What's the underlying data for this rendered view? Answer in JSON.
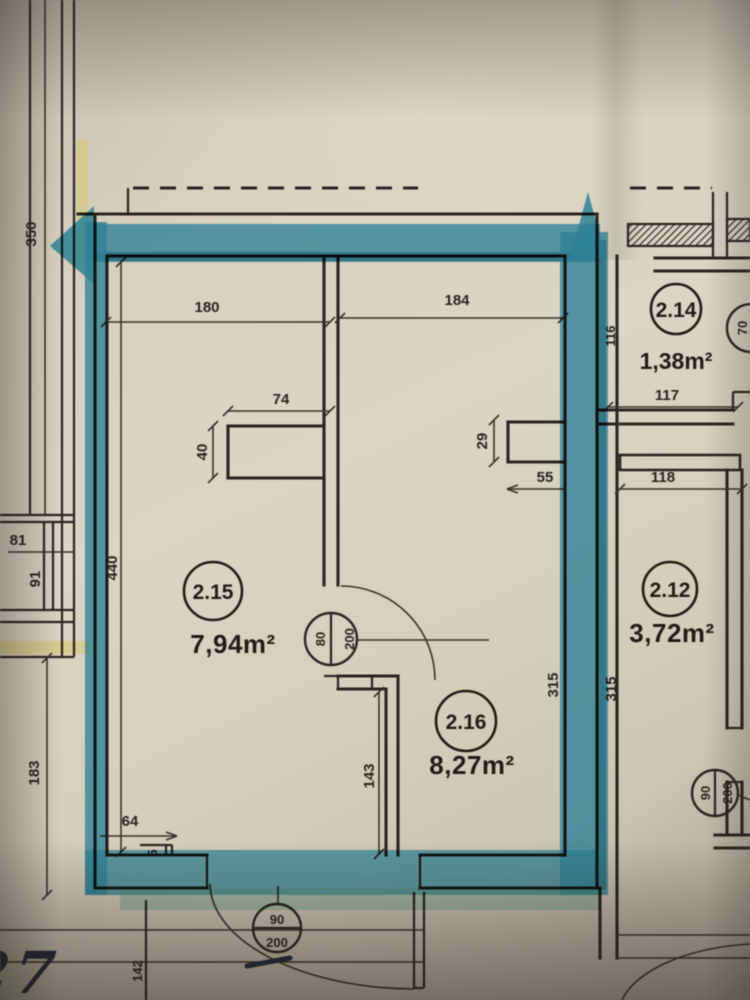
{
  "rooms": [
    {
      "id": "2.15",
      "area": "7,94m²"
    },
    {
      "id": "2.16",
      "area": "8,27m²"
    },
    {
      "id": "2.14",
      "area": "1,38m²"
    },
    {
      "id": "2.12",
      "area": "3,72m²"
    }
  ],
  "doors": {
    "interior": {
      "width": "80",
      "height": "200"
    },
    "entrance": {
      "width": "90",
      "height": "200"
    },
    "neighbor": {
      "width": "90",
      "height": "200"
    },
    "window": {
      "width": "70"
    }
  },
  "dims": {
    "d350": "350",
    "d180": "180",
    "d184": "184",
    "d74": "74",
    "d40": "40",
    "d29": "29",
    "d55": "55",
    "d116": "116",
    "d117": "117",
    "d118": "118",
    "d440": "440",
    "d81": "81",
    "d91": "91",
    "d315_left": "315",
    "d315_right": "315",
    "d183": "183",
    "d64": "64",
    "d5": "5",
    "d143": "143",
    "d142": "142"
  },
  "handwriting": {
    "text": "lok. : 27"
  },
  "colors": {
    "highlighter_teal": "#298298",
    "highlighter_yellow": "#cdc364",
    "ink": "#2c2620",
    "pen_ink": "#262c42",
    "paper": "#d8d1bf"
  }
}
